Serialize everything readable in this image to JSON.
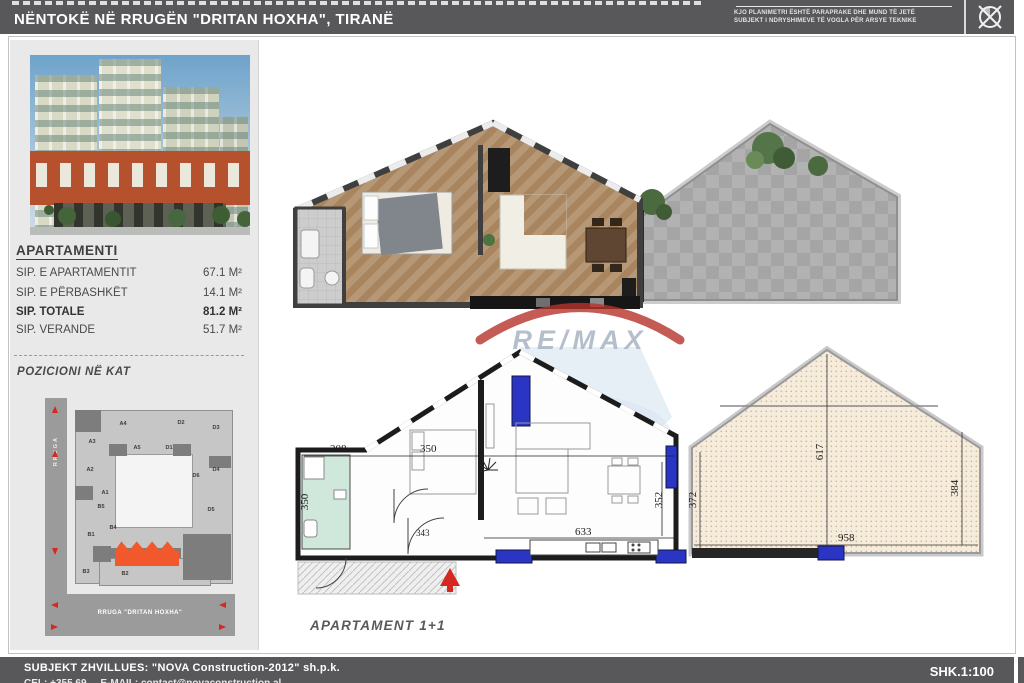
{
  "header": {
    "title": "NËNTOKË NË RRUGËN \"DRITAN HOXHA\", TIRANË",
    "disclaimer_line1": "KJO PLANIMETRI ËSHTË PARAPRAKE DHE MUND TË JETË",
    "disclaimer_line2": "SUBJEKT I NDRYSHIMEVE TË VOGLA PËR ARSYE TEKNIKE"
  },
  "sidebar": {
    "apartment": {
      "heading": "APARTAMENTI",
      "rows": [
        {
          "label": "SIP. E APARTAMENTIT",
          "value": "67.1 M²"
        },
        {
          "label": "SIP. E PËRBASHKËT",
          "value": "14.1 M²"
        },
        {
          "label": "SIP. TOTALE",
          "value": "81.2 M²"
        },
        {
          "label": "SIP. VERANDE",
          "value": "51.7 M²"
        }
      ]
    },
    "position_heading": "POZICIONI NË KAT",
    "keyplan": {
      "street_left": "RRUGA",
      "street_bottom": "RRUGA \"DRITAN HOXHA\"",
      "highlight_color": "#f1582c",
      "units": [
        "A4",
        "D2",
        "D3",
        "A3",
        "A5",
        "D1",
        "A2",
        "D6",
        "D4",
        "A1",
        "B5",
        "D5",
        "B4",
        "B1",
        "B3",
        "B2"
      ]
    }
  },
  "plans": {
    "top": {
      "watermark": "RE/MAX"
    },
    "bottom": {
      "label": "APARTAMENT 1+1",
      "dims": {
        "d208": "208",
        "d350_bath": "350",
        "d350_bed": "350",
        "d343": "343",
        "d352": "352",
        "d633": "633",
        "d372": "372",
        "d617": "617",
        "d958": "958",
        "d384": "384"
      }
    }
  },
  "footer": {
    "developer": "SUBJEKT ZHVILLUES: \"NOVA Construction-2012\" sh.p.k.",
    "contact_truncated": "CEL: +355 69 ...    E-MAIL: contact@novaconstruction.al",
    "scale": "SHK.1:100"
  }
}
